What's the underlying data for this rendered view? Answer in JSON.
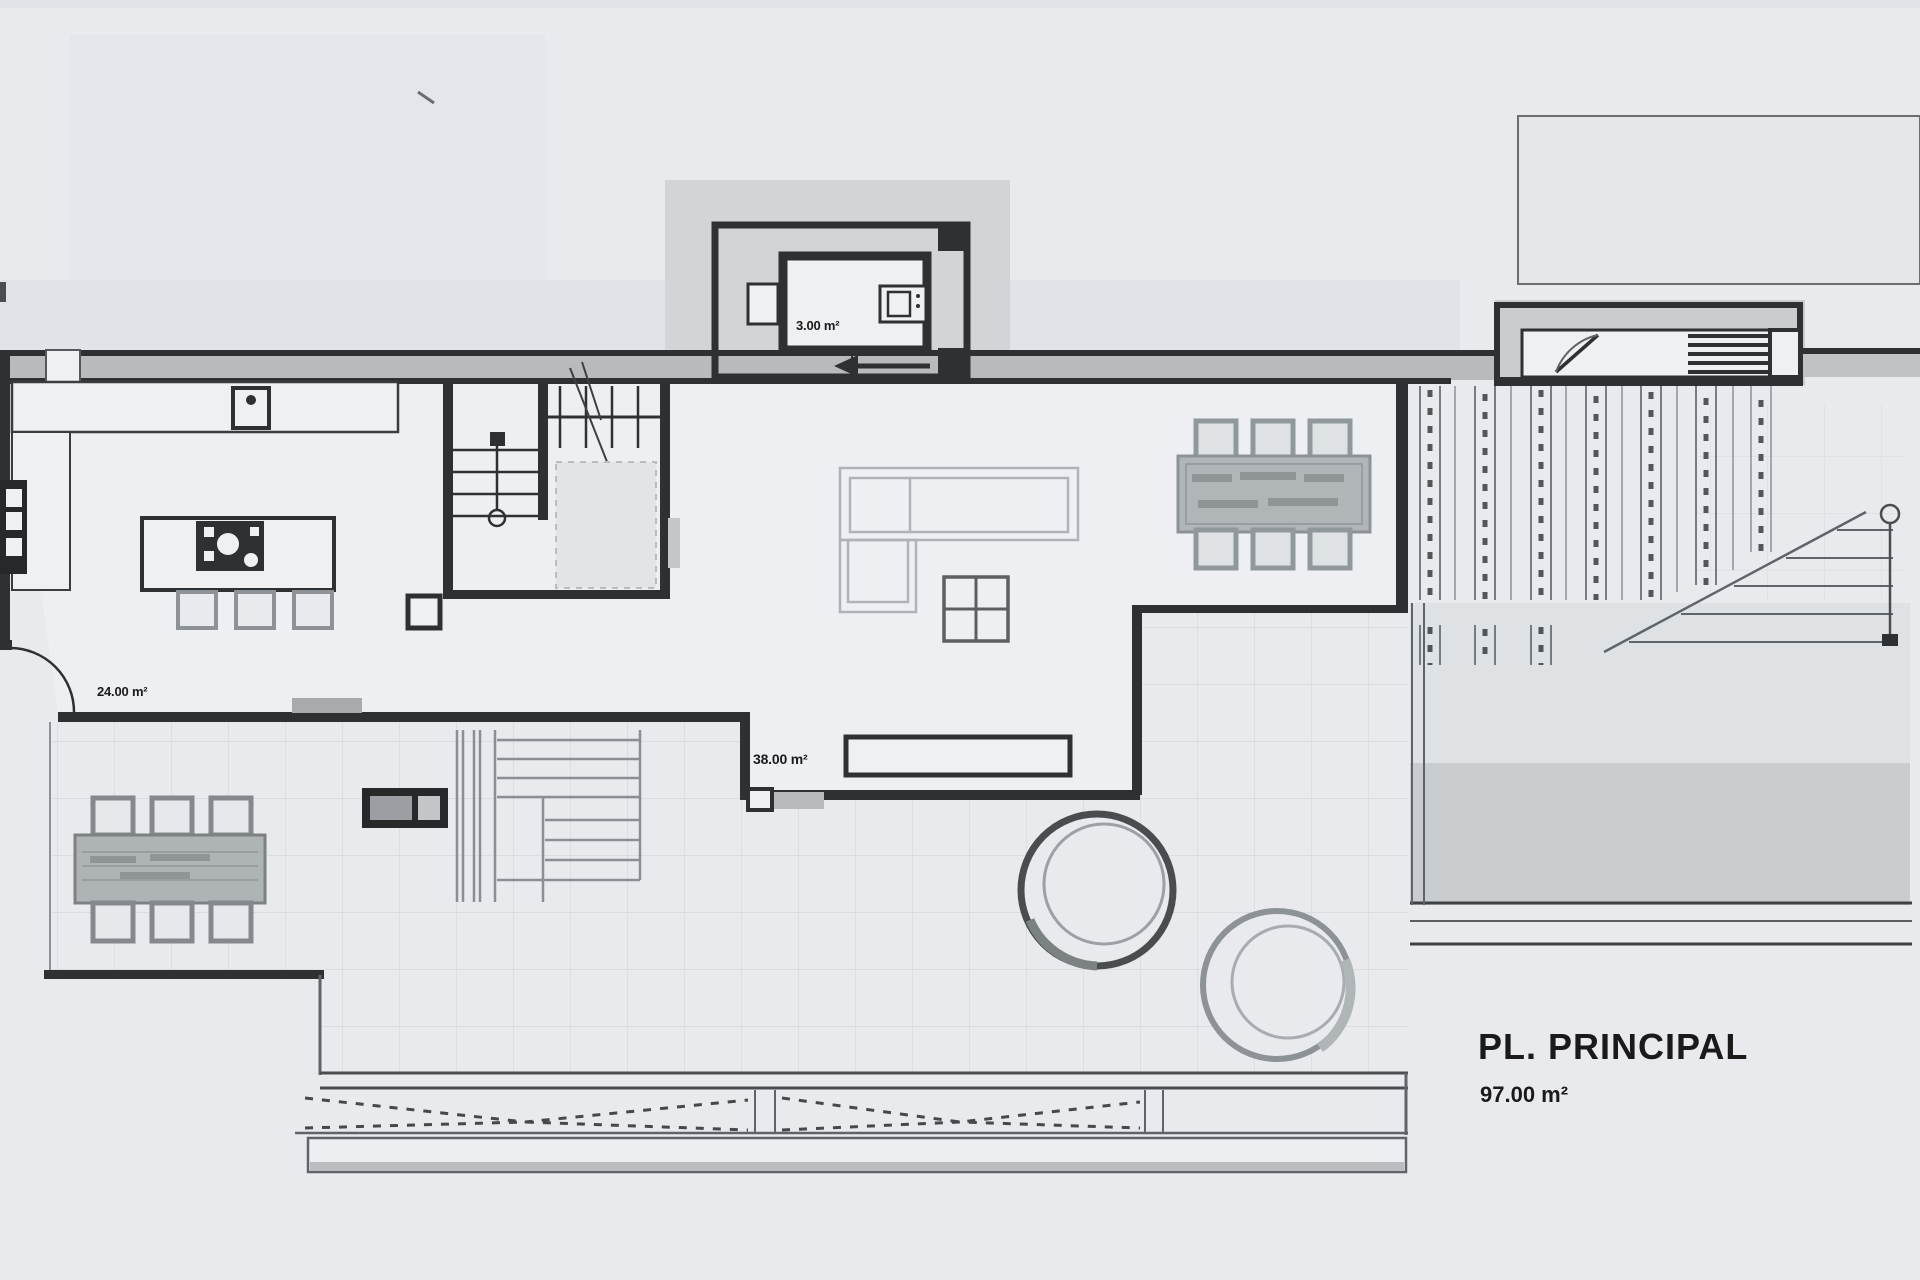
{
  "labels": {
    "wc_area": "3.00 m²",
    "kitchen_dining_area": "24.00 m²",
    "living_area": "38.00 m²",
    "floor_title": "PL. PRINCIPAL",
    "floor_area": "97.00 m²"
  },
  "colors": {
    "bg": "#e8eaed",
    "interior": "#edeff2",
    "wall": "#2e3133",
    "poche": "#b7bbbd",
    "greyPatch": "#d2d5d7",
    "gridLine": "#d6d9dd",
    "furnitureLight": "#aeb3b9",
    "furnitureMid": "#8d9296",
    "tableFill": "#b0b5b8",
    "text": "#1a1a1a"
  }
}
